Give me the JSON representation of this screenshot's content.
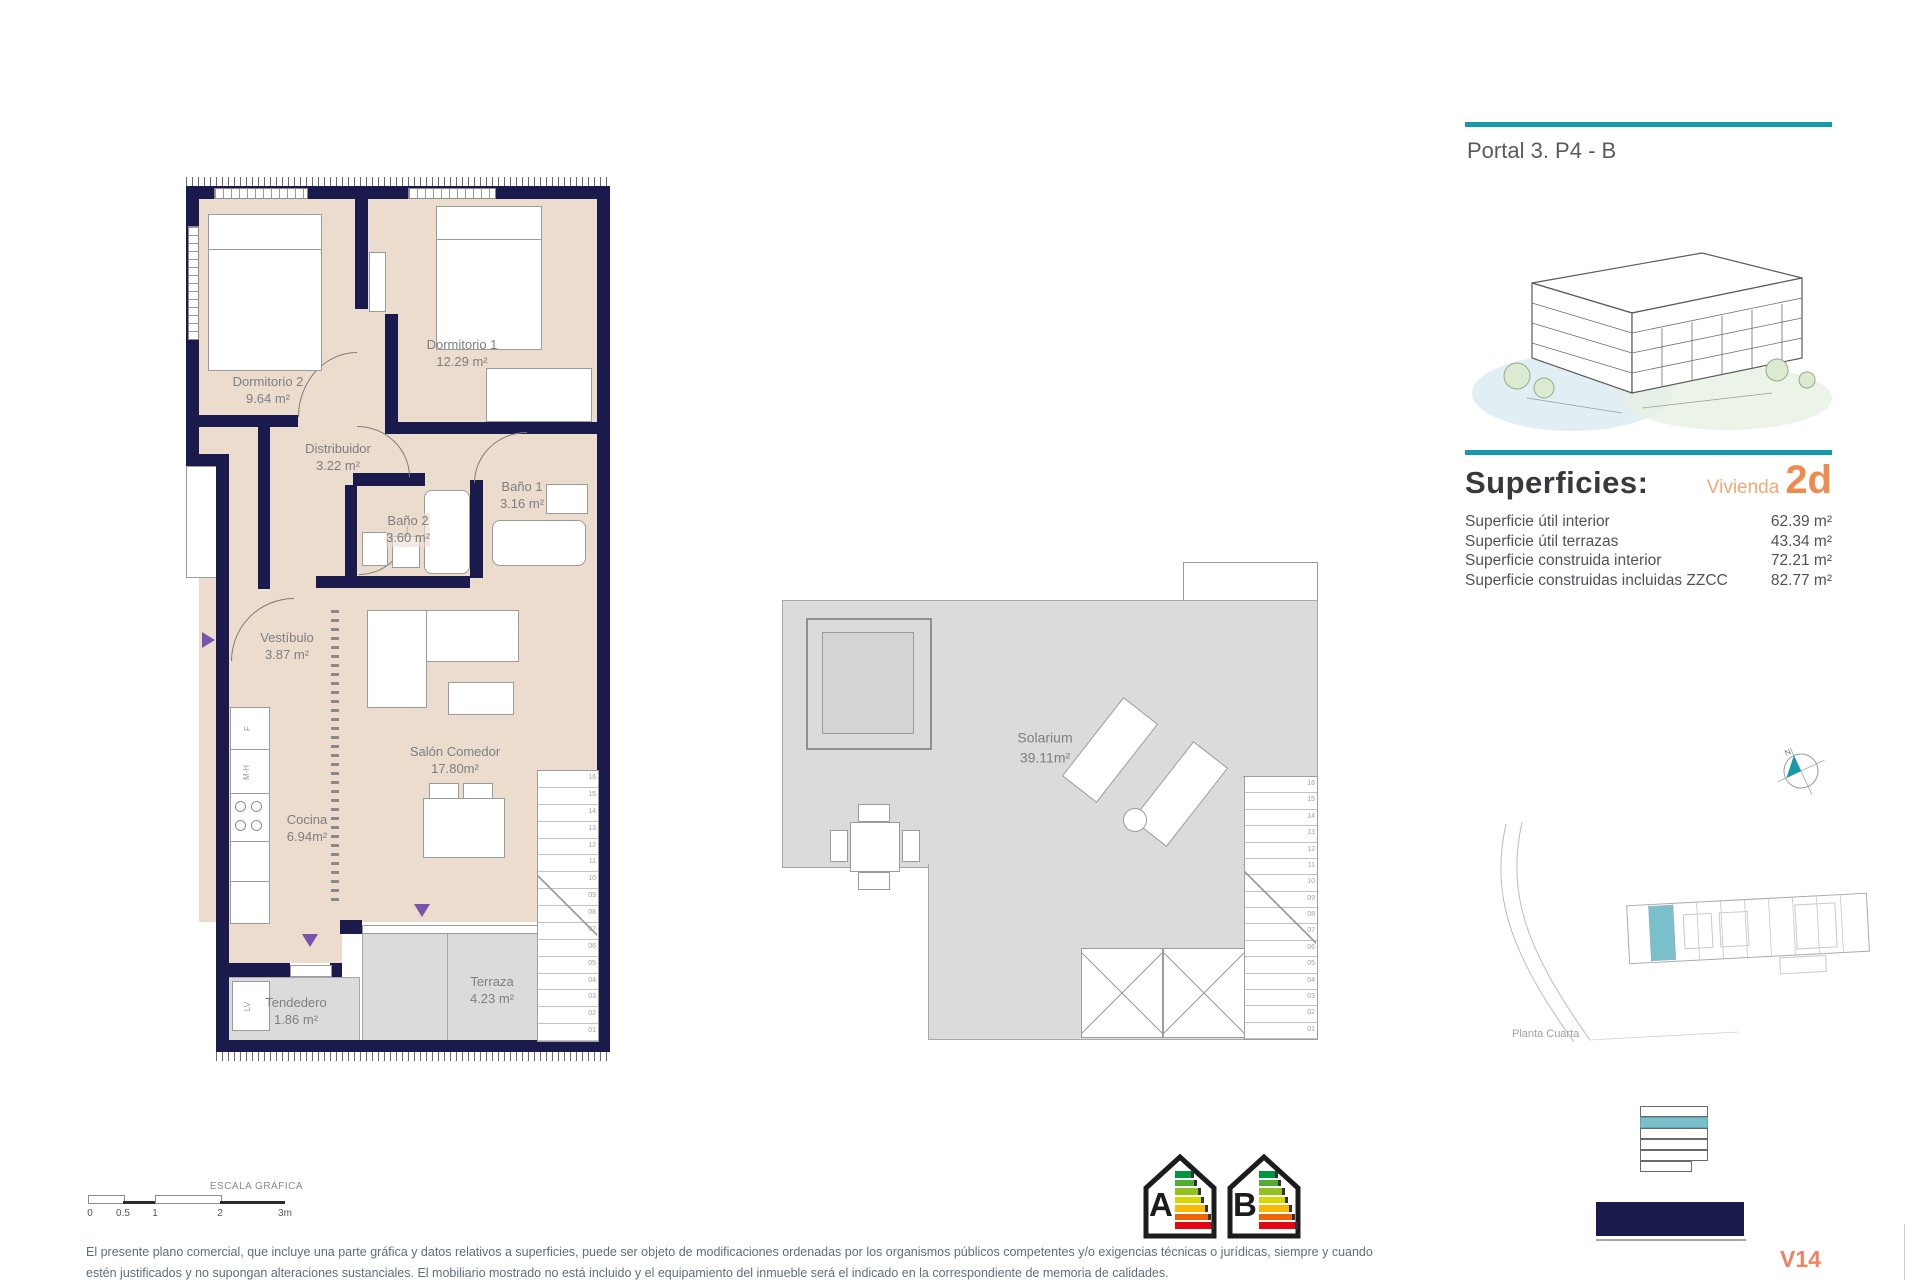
{
  "header": {
    "portal": "Portal 3. P4 - B"
  },
  "superficies": {
    "title": "Superficies:",
    "vivienda_label": "Vivienda",
    "vivienda_code": "2d",
    "rows": [
      {
        "label": "Superficie útil interior",
        "value": "62.39 m²"
      },
      {
        "label": "Superficie útil terrazas",
        "value": "43.34 m²"
      },
      {
        "label": "Superficie construida interior",
        "value": "72.21 m²"
      },
      {
        "label": "Superficie construidas incluidas ZZCC",
        "value": "82.77 m²"
      }
    ]
  },
  "floor_plan": {
    "rooms": [
      {
        "name": "Dormitorio 2",
        "area": "9.64 m²"
      },
      {
        "name": "Dormitorio 1",
        "area": "12.29 m²"
      },
      {
        "name": "Distribuidor",
        "area": "3.22 m²"
      },
      {
        "name": "Baño 1",
        "area": "3.16 m²"
      },
      {
        "name": "Baño 2",
        "area": "3.60 m²"
      },
      {
        "name": "Vestíbulo",
        "area": "3.87 m²"
      },
      {
        "name": "Salón Comedor",
        "area": "17.80m²"
      },
      {
        "name": "Cocina",
        "area": "6.94m²"
      },
      {
        "name": "Tendedero",
        "area": "1.86 m²"
      },
      {
        "name": "Terraza",
        "area": "4.23 m²"
      }
    ],
    "kitchen_labels": {
      "fridge": "F",
      "oven": "M-H",
      "washer": "LV"
    }
  },
  "stairs": {
    "numbers": [
      "16",
      "15",
      "14",
      "13",
      "12",
      "11",
      "10",
      "09",
      "08",
      "07",
      "06",
      "05",
      "04",
      "03",
      "02",
      "01"
    ]
  },
  "solarium": {
    "name": "Solarium",
    "area": "39.11m²"
  },
  "site_plan": {
    "caption": "Planta Cuarta"
  },
  "compass": {
    "north": "N"
  },
  "scale_bar": {
    "title": "ESCALA GRÁFICA",
    "ticks": [
      "0",
      "0.5",
      "1",
      "2",
      "3m"
    ]
  },
  "energy": {
    "labels": [
      "A",
      "B"
    ],
    "bar_colors": [
      "#009640",
      "#52ae32",
      "#95c11f",
      "#d8d800",
      "#fbba00",
      "#ec6608",
      "#e30613"
    ]
  },
  "footer": {
    "line1": "El presente plano comercial, que incluye una parte gráfica y datos relativos a superficies, puede ser objeto de modificaciones ordenadas por los organismos públicos competentes y/o exigencias técnicas o jurídicas, siempre y cuando",
    "line2": "estén justificados y no supongan alteraciones sustanciales. El mobiliario mostrado no está incluido y el equipamiento del inmueble será el indicado en la correspondiente de memoria de calidades.",
    "sheet_code": "V14"
  },
  "colors": {
    "teal": "#1899a9",
    "orange": "#ee8b4e",
    "navy": "#1a1a4c",
    "beige": "#ebdccd",
    "grey_floor": "#dbdbdb",
    "purple": "#7b52ae"
  }
}
